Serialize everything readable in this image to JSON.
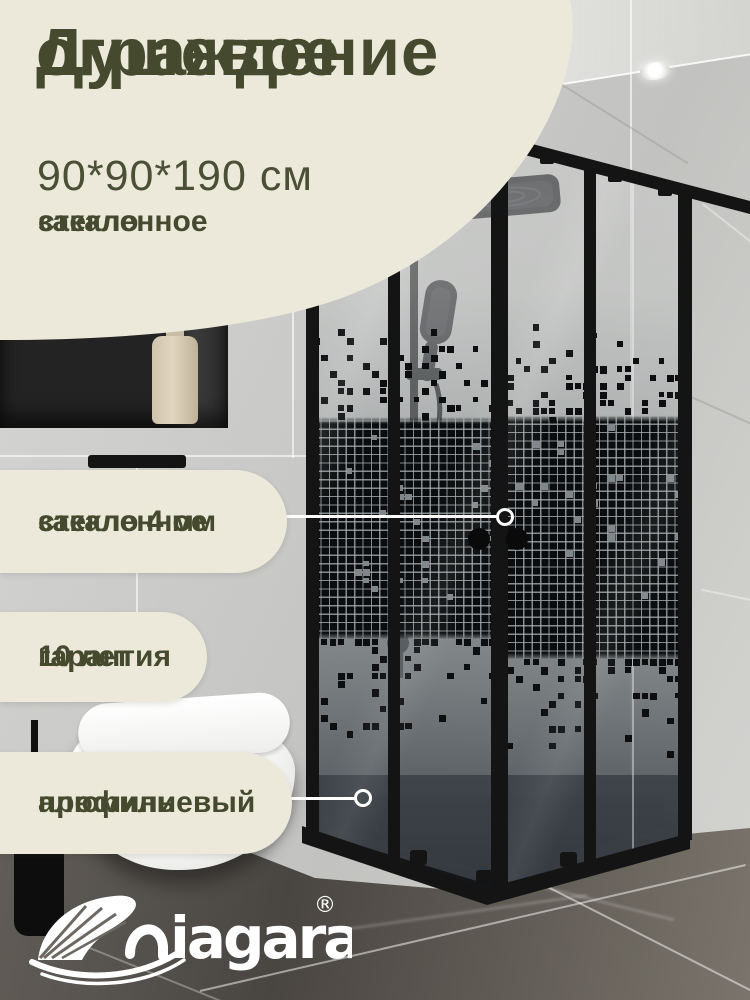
{
  "card": {
    "headline": {
      "line1": "Душевое",
      "line2": "ограждение"
    },
    "dimensions": "90*90*190 см",
    "subfeature": {
      "line1": "закаленное",
      "line2": "стекло"
    },
    "callouts": {
      "glass": {
        "line1": "закаленное",
        "line2": "стекло 4 мм"
      },
      "warranty": {
        "line1": "гарантия",
        "line2": "10 лет"
      },
      "profile": {
        "line1": "алюминиевый",
        "line2": "профиль"
      }
    },
    "brand": {
      "name": "niagara",
      "display_text": "iagara",
      "registered_mark": "®"
    },
    "colors": {
      "panel_cream": "#ece9da",
      "text_olive": "#454a2e",
      "frame_black": "#151515",
      "pointer_white": "#ffffff"
    }
  }
}
